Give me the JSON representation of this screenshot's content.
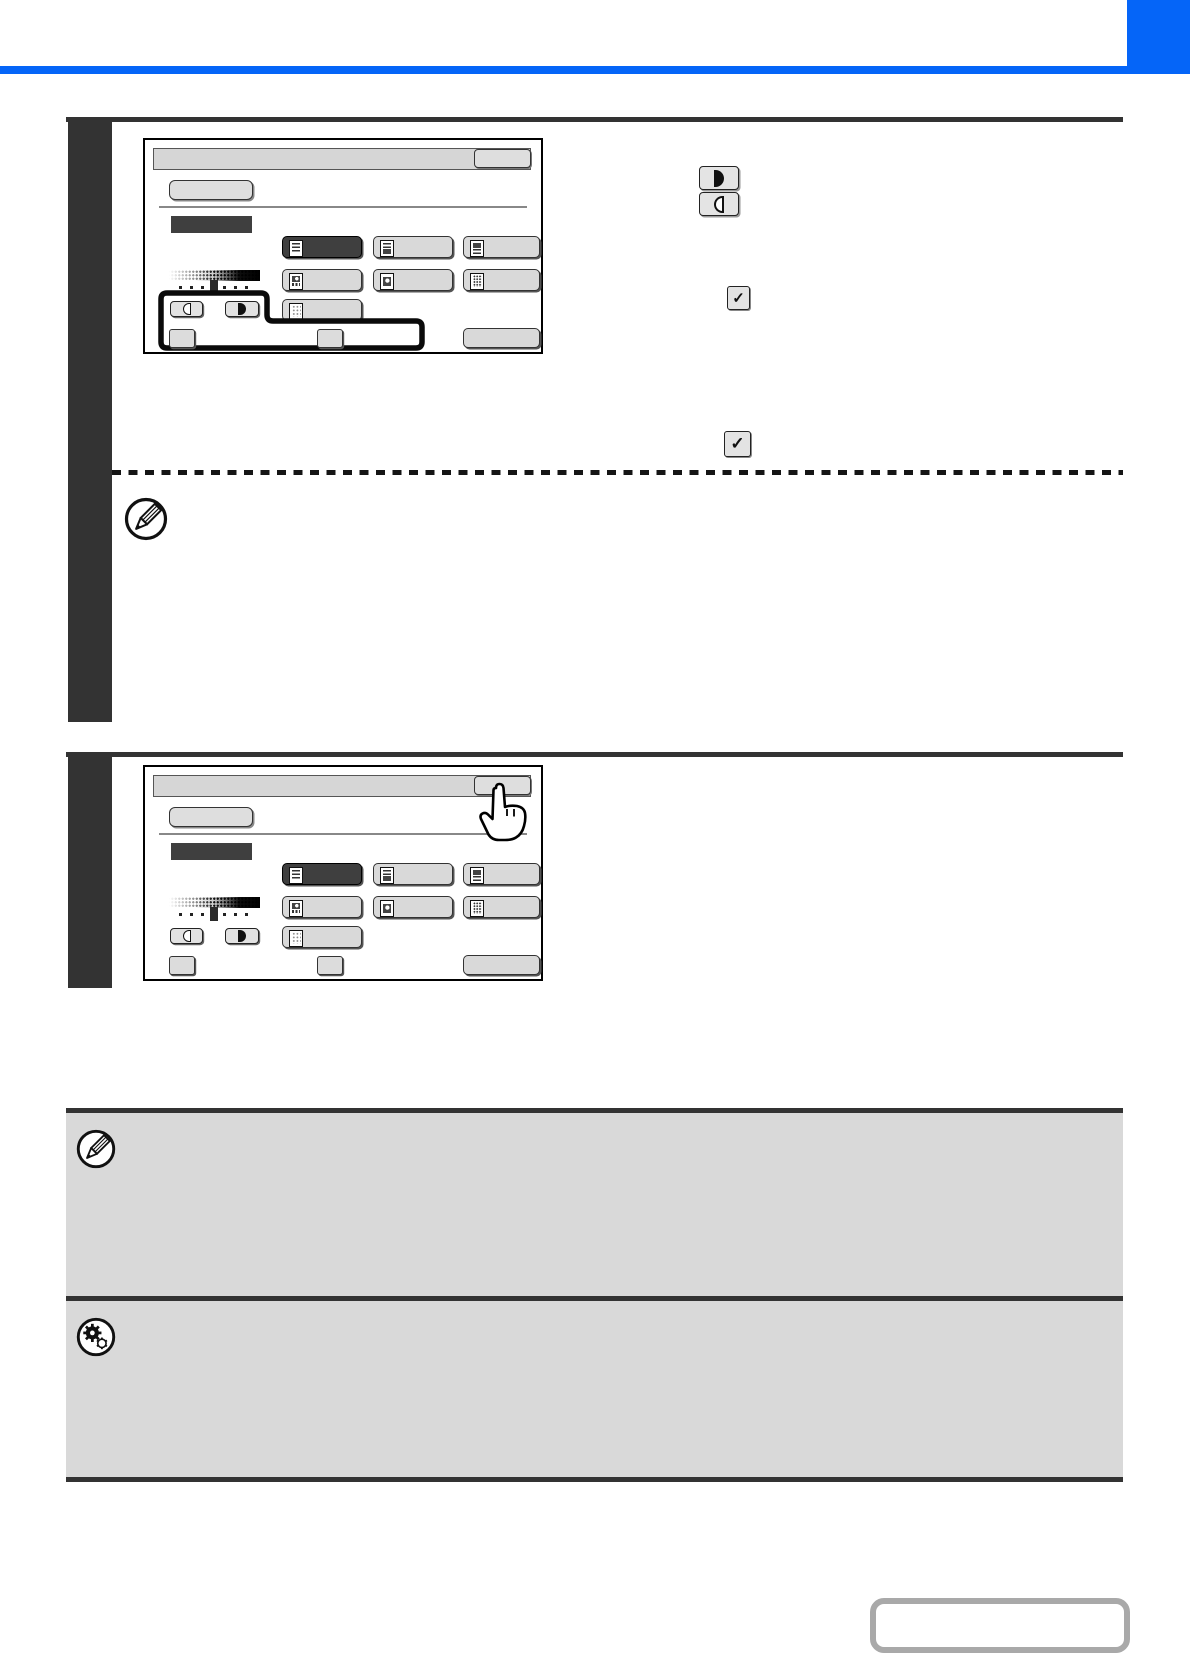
{
  "page": {
    "background": "#ffffff",
    "accent_color": "#0565f8",
    "rule_color": "#333333",
    "note_box_color": "#d9d9d9",
    "selected_key_color": "#3f3f3f",
    "text_content_visible": false
  },
  "glyphs": {
    "check": "✓"
  },
  "touch_panel": {
    "title_bar": {
      "label": ""
    },
    "ok_button": {
      "label": ""
    },
    "exposure_button": {
      "label": ""
    },
    "selected_mode_banner": {
      "label": "",
      "color": "#3f3f3f"
    },
    "mode_buttons": [
      {
        "icon": "text-original-icon",
        "selected": true,
        "label": ""
      },
      {
        "icon": "text-printed-photo-icon",
        "selected": false,
        "label": ""
      },
      {
        "icon": "text-photo-icon",
        "selected": false,
        "label": ""
      },
      {
        "icon": "printed-photo-icon",
        "selected": false,
        "label": ""
      },
      {
        "icon": "photo-icon",
        "selected": false,
        "label": ""
      },
      {
        "icon": "map-icon",
        "selected": false,
        "label": ""
      },
      {
        "icon": "light-original-icon",
        "selected": false,
        "label": ""
      }
    ],
    "exposure_scale": {
      "levels": 7,
      "selected_level": 4
    },
    "lighten_key": {
      "icon": "lighten-half-circle-icon",
      "label": ""
    },
    "darken_key": {
      "icon": "darken-half-circle-icon",
      "label": ""
    },
    "bottom_keys": [
      {
        "type": "checkbox-key",
        "label": ""
      },
      {
        "type": "checkbox-key",
        "label": ""
      },
      {
        "type": "wide-key",
        "label": ""
      }
    ]
  },
  "screens": [
    {
      "step": 1,
      "highlight_outline": true,
      "hand_cursor": false
    },
    {
      "step": 2,
      "highlight_outline": false,
      "hand_cursor": true
    }
  ],
  "inline_keys": [
    {
      "icon": "darken-half-circle-icon"
    },
    {
      "icon": "lighten-half-circle-icon"
    },
    {
      "icon": "check-key-icon",
      "glyph": "✓"
    },
    {
      "icon": "check-key-icon",
      "glyph": "✓"
    }
  ],
  "notes": [
    {
      "icon": "pencil-icon",
      "style": "inline-dashed-note",
      "text": ""
    },
    {
      "icon": "pencil-icon",
      "style": "gray-note-box",
      "text": ""
    },
    {
      "icon": "registration-gear-icon",
      "style": "gray-note-box",
      "text": ""
    }
  ],
  "footer": {
    "contents_button": {
      "label": ""
    }
  }
}
